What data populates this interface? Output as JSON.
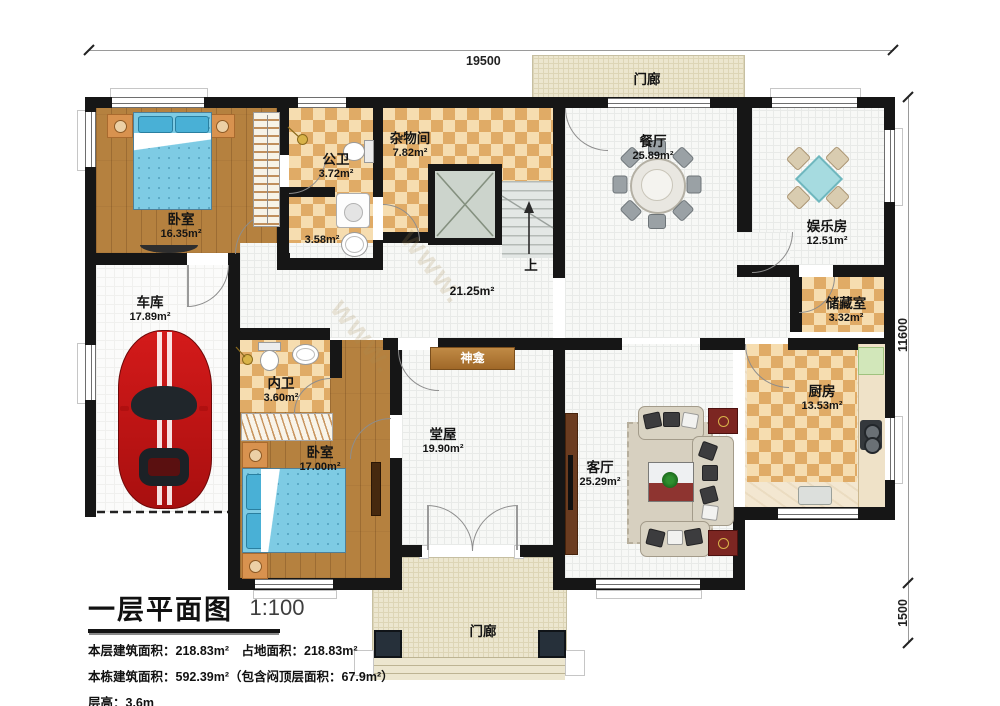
{
  "watermark": "www.",
  "dimensions": {
    "top": "19500",
    "right_main": "11600",
    "right_porch": "1500"
  },
  "stairs": {
    "up": "上"
  },
  "rooms": {
    "bedroom1": {
      "name": "卧室",
      "area": "16.35m²"
    },
    "public_bath": {
      "name": "公卫",
      "area": "3.72m²"
    },
    "bath_lobby": {
      "area": "3.58m²"
    },
    "utility": {
      "name": "杂物间",
      "area": "7.82m²"
    },
    "hall": {
      "area": "21.25m²"
    },
    "dining": {
      "name": "餐厅",
      "area": "25.89m²"
    },
    "entertainment": {
      "name": "娱乐房",
      "area": "12.51m²"
    },
    "storage": {
      "name": "储藏室",
      "area": "3.32m²"
    },
    "kitchen": {
      "name": "厨房",
      "area": "13.53m²"
    },
    "garage": {
      "name": "车库",
      "area": "17.89m²"
    },
    "inner_bath": {
      "name": "内卫",
      "area": "3.60m²"
    },
    "bedroom2": {
      "name": "卧室",
      "area": "17.00m²"
    },
    "main_hall": {
      "name": "堂屋",
      "area": "19.90m²"
    },
    "living": {
      "name": "客厅",
      "area": "25.29m²"
    },
    "shrine": {
      "name": "神龛"
    },
    "porch_top": {
      "name": "门廊"
    },
    "porch_bottom": {
      "name": "门廊"
    }
  },
  "title_block": {
    "title": "一层平面图",
    "scale": "1:100",
    "line1": "本层建筑面积：218.83m²　占地面积：218.83m²",
    "line2": "本栋建筑面积：592.39m²（包含闷顶层面积：67.9m²）",
    "line3": "层高：3.6m"
  }
}
